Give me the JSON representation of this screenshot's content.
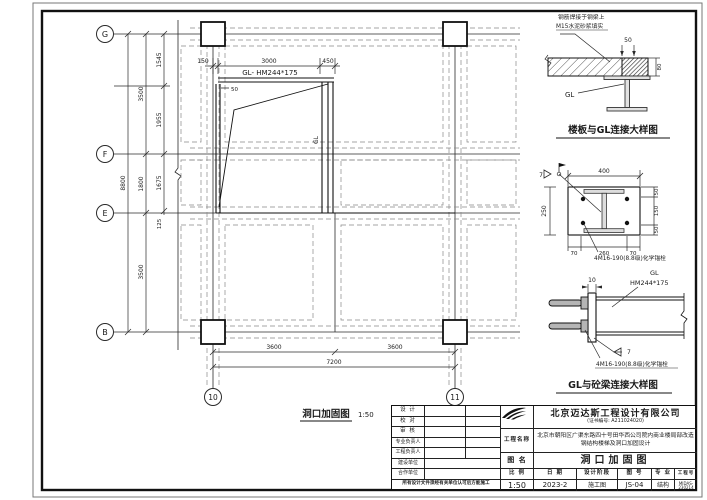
{
  "plan": {
    "grid_rows": [
      "G",
      "F",
      "E",
      "B"
    ],
    "grid_cols": [
      "10",
      "11"
    ],
    "beam_label": "GL- HM244*175",
    "gl_vertical": "GL",
    "dim_small": "50",
    "dims_top": [
      "150",
      "3000",
      "450"
    ],
    "dim_total_left": "8800",
    "dims_left_major": [
      "3500",
      "1800",
      "3500"
    ],
    "dims_left_minor": [
      "1545",
      "1955",
      "1675",
      "125"
    ],
    "dims_bottom": [
      "3600",
      "3600"
    ],
    "dim_total_bottom": "7200",
    "caption": "洞口加固图",
    "caption_scale": "1:50"
  },
  "detail_slab": {
    "caption": "楼板与GL连接大样图",
    "note_line1": "钢筋焊接于钢梁上",
    "note_line2": "M15水泥砂浆填实",
    "dim_top": "50",
    "dim_thickness": "80",
    "gl_label": "GL"
  },
  "detail_plate": {
    "dim_width": "400",
    "dim_height": "250",
    "dims_right": [
      "50",
      "150",
      "50"
    ],
    "dims_bottom": [
      "70",
      "260",
      "70"
    ],
    "weld_size": "7",
    "anchor_note": "4M16-190(8.8级)化学锚栓"
  },
  "detail_beam": {
    "caption": "GL与砼梁连接大样图",
    "gl_label": "GL",
    "beam_size": "HM244*175",
    "dim_plate": "10",
    "weld_size": "7",
    "anchor_note": "4M16-190(8.8级)化学锚栓"
  },
  "title_block": {
    "rows": [
      {
        "label": "设 计"
      },
      {
        "label": "校 对"
      },
      {
        "label": "审 核"
      },
      {
        "label": "专业负责人"
      },
      {
        "label": "工程负责人"
      },
      {
        "label": "建设单位"
      },
      {
        "label": "合作单位"
      }
    ],
    "note": "所有设计文件须经有关单位认可后方能施工",
    "company": "北京迈达斯工程设计有限公司",
    "cert": "(证书编号: A211024020)",
    "project_label": "工程名称",
    "project_name": "北京市朝阳区广渠东路四十号田华西公司院内商业楼局部改造钢结构楼梯及洞口加固设计",
    "drawing_label": "图  名",
    "drawing_name": "洞口加固图",
    "scale_label": "比 例",
    "scale_value": "1:50",
    "date_label": "日 期",
    "date_value": "2023-2",
    "stage_label": "设计阶段",
    "stage_value": "施工图",
    "number_label": "图 号",
    "number_value": "JS-04",
    "discipline_label": "专 业",
    "discipline_value": "结构",
    "job_label": "工程号",
    "job_value": "MIDAS-230214"
  }
}
